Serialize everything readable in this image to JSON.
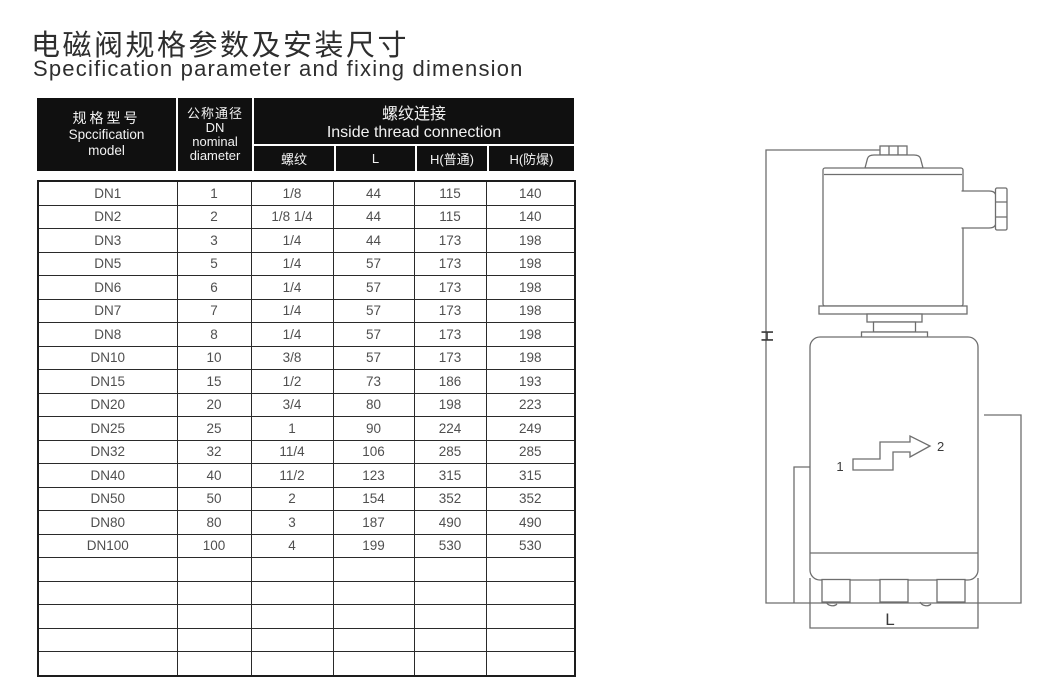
{
  "title": {
    "zh": "电磁阀规格参数及安装尺寸",
    "en": "Specification parameter and fixing dimension"
  },
  "table": {
    "header": {
      "spec": {
        "zh": "规格型号",
        "en_line1": "Spccification",
        "en_line2": "model"
      },
      "dn": {
        "zh": "公称通径",
        "line2": "DN",
        "line3": "nominal",
        "line4": "diameter"
      },
      "thread_group": {
        "zh": "螺纹连接",
        "en": "Inside thread connection"
      },
      "sub_columns": [
        "螺纹",
        "L",
        "H(普通)",
        "H(防爆)"
      ]
    },
    "rows": [
      [
        "DN1",
        "1",
        "1/8",
        "44",
        "115",
        "140"
      ],
      [
        "DN2",
        "2",
        "1/8 1/4",
        "44",
        "115",
        "140"
      ],
      [
        "DN3",
        "3",
        "1/4",
        "44",
        "173",
        "198"
      ],
      [
        "DN5",
        "5",
        "1/4",
        "57",
        "173",
        "198"
      ],
      [
        "DN6",
        "6",
        "1/4",
        "57",
        "173",
        "198"
      ],
      [
        "DN7",
        "7",
        "1/4",
        "57",
        "173",
        "198"
      ],
      [
        "DN8",
        "8",
        "1/4",
        "57",
        "173",
        "198"
      ],
      [
        "DN10",
        "10",
        "3/8",
        "57",
        "173",
        "198"
      ],
      [
        "DN15",
        "15",
        "1/2",
        "73",
        "186",
        "193"
      ],
      [
        "DN20",
        "20",
        "3/4",
        "80",
        "198",
        "223"
      ],
      [
        "DN25",
        "25",
        "1",
        "90",
        "224",
        "249"
      ],
      [
        "DN32",
        "32",
        "11/4",
        "106",
        "285",
        "285"
      ],
      [
        "DN40",
        "40",
        "11/2",
        "123",
        "315",
        "315"
      ],
      [
        "DN50",
        "50",
        "2",
        "154",
        "352",
        "352"
      ],
      [
        "DN80",
        "80",
        "3",
        "187",
        "490",
        "490"
      ],
      [
        "DN100",
        "100",
        "4",
        "199",
        "530",
        "530"
      ]
    ],
    "empty_rows": 5
  },
  "drawing": {
    "dim_height_label": "H",
    "dim_length_label": "L",
    "inlet_label": "1",
    "outlet_label": "2"
  },
  "colors": {
    "header_bg": "#101010",
    "header_text": "#f2f2f2",
    "table_border": "#1d1d1d",
    "body_text": "#4f4f4f",
    "drawing_line": "#6e6e6e",
    "title_color": "#2e2e2e"
  }
}
